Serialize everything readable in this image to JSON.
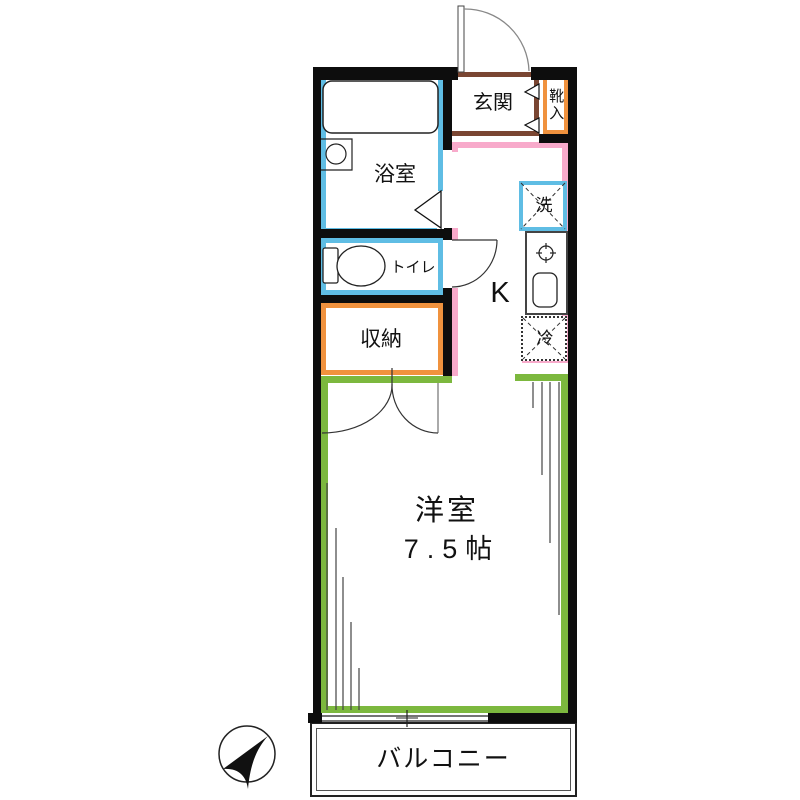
{
  "title": "Japanese apartment floor plan (1K, 7.5 tatami)",
  "rooms": {
    "genkan": {
      "label": "玄関"
    },
    "shoe_cabinet": {
      "label": "靴入"
    },
    "bathroom": {
      "label": "浴室"
    },
    "toilet": {
      "label": "トイレ"
    },
    "storage": {
      "label": "収納"
    },
    "kitchen": {
      "label": "K"
    },
    "washer": {
      "label": "洗"
    },
    "fridge": {
      "label": "冷"
    },
    "western_room": {
      "label": "洋室",
      "size": "7.5帖"
    },
    "balcony": {
      "label": "バルコニー"
    }
  },
  "colors": {
    "wall": "#0d0d0d",
    "wet_area_blue": "#5fbde4",
    "storage_orange": "#f0923e",
    "genkan_brown": "#7a4632",
    "kitchen_pink": "#f8aacb",
    "room_green": "#7cb83e"
  },
  "icons": {
    "compass": "north-arrow-icon (points upper-right)",
    "bathtub": "bathtub-icon",
    "washbasin": "washbasin-icon",
    "toilet_bowl": "toilet-bowl-icon",
    "stove_burner": "stove-burner-icon",
    "kitchen_sink": "kitchen-sink-icon",
    "washer_box": "washing-machine-placeholder-icon",
    "fridge_box": "refrigerator-placeholder-icon",
    "doors": "door-swing-arc"
  }
}
